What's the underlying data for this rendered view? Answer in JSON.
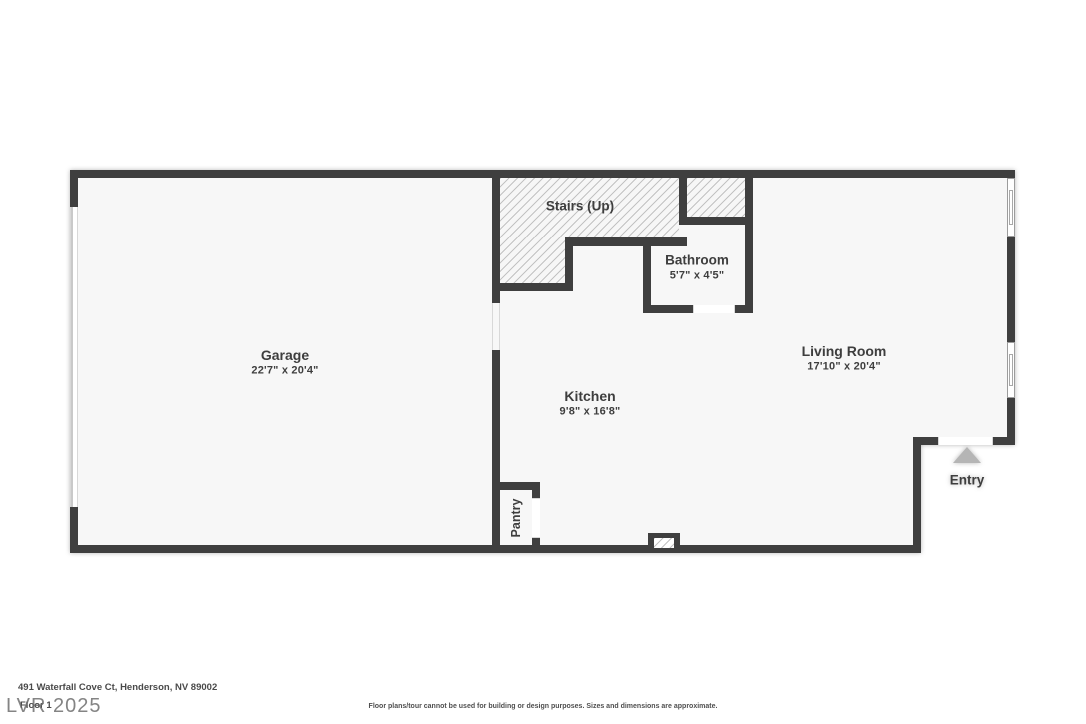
{
  "rooms": {
    "garage": {
      "name": "Garage",
      "dims": "22'7\" x 20'4\""
    },
    "stairs": {
      "name": "Stairs (Up)"
    },
    "bathroom": {
      "name": "Bathroom",
      "dims": "5'7\" x 4'5\""
    },
    "kitchen": {
      "name": "Kitchen",
      "dims": "9'8\" x 16'8\""
    },
    "living_room": {
      "name": "Living Room",
      "dims": "17'10\" x 20'4\""
    },
    "pantry": {
      "name": "Pantry"
    },
    "entry": {
      "name": "Entry"
    }
  },
  "footer": {
    "address": "491 Waterfall Cove Ct, Henderson, NV 89002",
    "floor_label": "Floor 1",
    "watermark": "LVR 2025",
    "disclaimer": "Floor plans/tour cannot be used for building or design purposes. Sizes and dimensions are approximate."
  },
  "colors": {
    "wall": "#3f3f3f",
    "floor": "#f7f7f7",
    "hatch": "#c3c3c3",
    "arrow": "#b5b5b5",
    "text": "#3e3e3e"
  }
}
